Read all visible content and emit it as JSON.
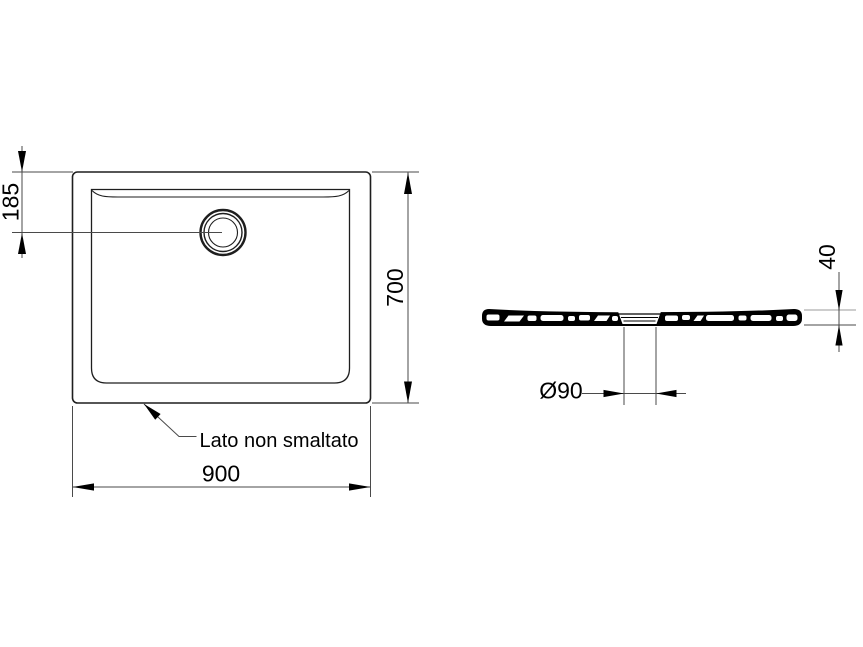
{
  "note": {
    "unglazed_side": "Lato non smaltato"
  },
  "dimensions": {
    "drain_offset": "185",
    "depth": "700",
    "width": "900",
    "drain_diameter": "Ø90",
    "height": "40"
  },
  "colors": {
    "background": "#ffffff",
    "thin_line": "#4a4a4a",
    "outline": "#1e1e1e",
    "ink": "#000000"
  }
}
